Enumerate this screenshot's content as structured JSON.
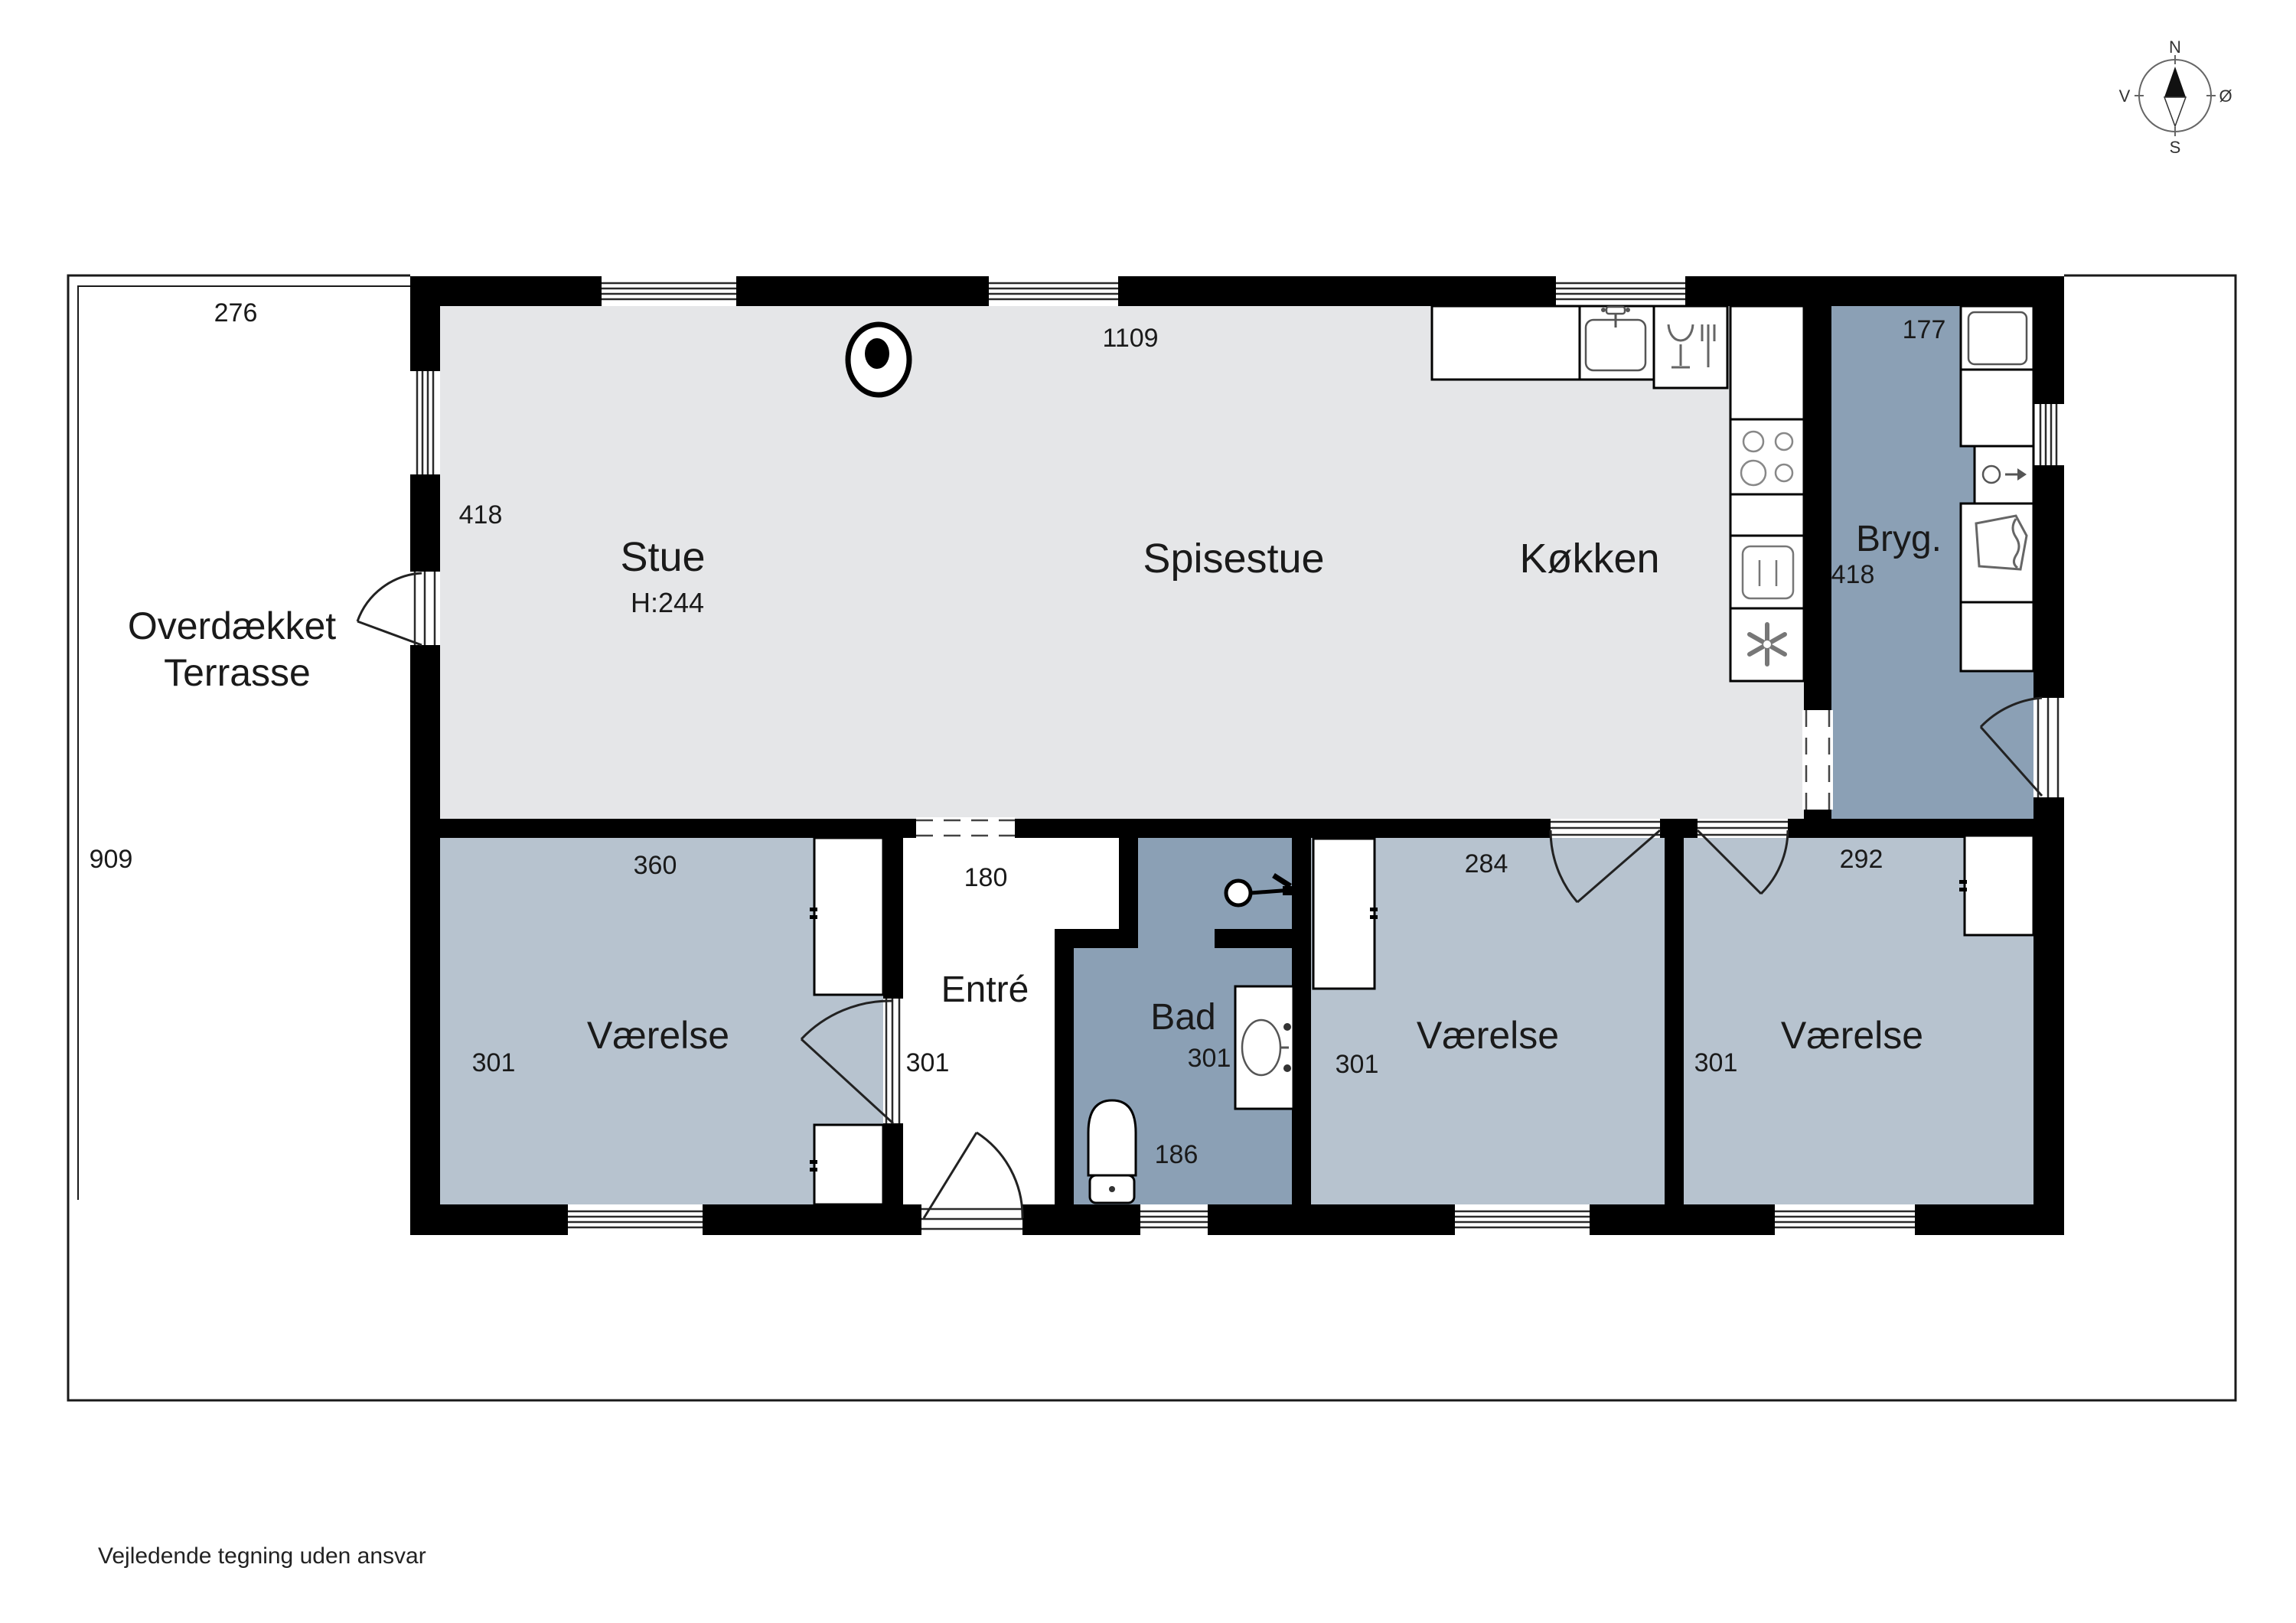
{
  "plan": {
    "title_note": "Vejledende tegning uden ansvar",
    "compass": {
      "north": "N",
      "south": "S",
      "west": "V",
      "east": "Ø"
    },
    "rooms": {
      "terrasse": {
        "name_line1": "Overdækket",
        "name_line2": "Terrasse",
        "dim_top": "276",
        "dim_left": "909"
      },
      "stue": {
        "name": "Stue",
        "ceiling_height": "H:244",
        "dim_left": "418",
        "dim_top": "1109"
      },
      "spisestue": {
        "name": "Spisestue"
      },
      "kokken": {
        "name": "Køkken"
      },
      "bryggers": {
        "name": "Bryg.",
        "dim_top": "177",
        "dim_left": "418"
      },
      "entre": {
        "name": "Entré",
        "dim_opening": "180",
        "dim_left": "301"
      },
      "bad": {
        "name": "Bad",
        "dim_left": "301",
        "dim_bottom": "186"
      },
      "vaerelse1": {
        "name": "Værelse",
        "dim_top": "360",
        "dim_left": "301"
      },
      "vaerelse2": {
        "name": "Værelse",
        "dim_top": "284",
        "dim_left": "301"
      },
      "vaerelse3": {
        "name": "Værelse",
        "dim_top": "292",
        "dim_left": "301"
      }
    },
    "icons": {
      "compass_rose": "compass-rose-icon",
      "wood_stove": "wood-stove-icon",
      "kitchen_sink": "kitchen-sink-icon",
      "dishwasher": "dishwasher-icon",
      "cooktop": "cooktop-burners-icon",
      "oven": "oven-icon",
      "freezer": "freezer-fan-icon",
      "washer": "washing-machine-icon",
      "utility_sink": "utility-sink-icon",
      "laundry_basket": "laundry-basket-icon",
      "shower": "shower-head-icon",
      "toilet": "toilet-icon",
      "vanity_sink": "vanity-sink-icon",
      "wardrobe": "wardrobe-icon",
      "window": "window-icon",
      "door": "door-swing-icon"
    },
    "colors": {
      "wall": "#000000",
      "floor_living": "#e5e6e8",
      "floor_bedroom": "#b7c3cf",
      "floor_wet": "#8ba0b5",
      "lot_line": "#1a1a1a"
    }
  }
}
